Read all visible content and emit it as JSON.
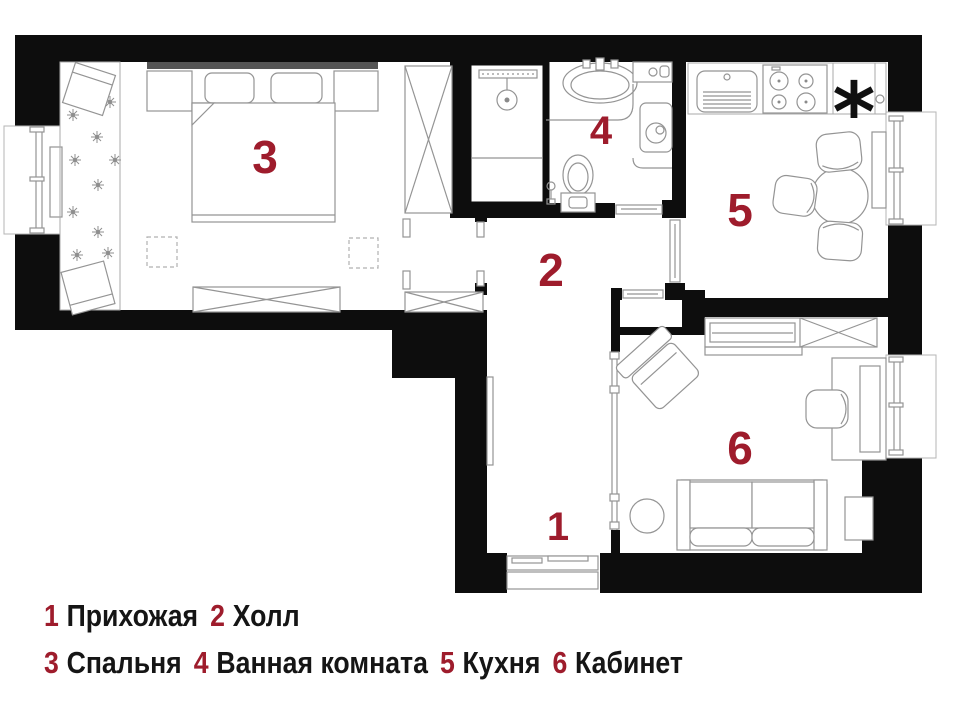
{
  "colors": {
    "wall": "#0d0d0d",
    "accent": "#9e1c2c",
    "furniture_line": "#949494"
  },
  "plan": {
    "type": "apartment-floor-plan",
    "rooms": [
      {
        "number": "1",
        "name": "Прихожая"
      },
      {
        "number": "2",
        "name": "Холл"
      },
      {
        "number": "3",
        "name": "Спальня"
      },
      {
        "number": "4",
        "name": "Ванная комната"
      },
      {
        "number": "5",
        "name": "Кухня"
      },
      {
        "number": "6",
        "name": "Кабинет"
      }
    ],
    "kitchen_marker": "*"
  }
}
